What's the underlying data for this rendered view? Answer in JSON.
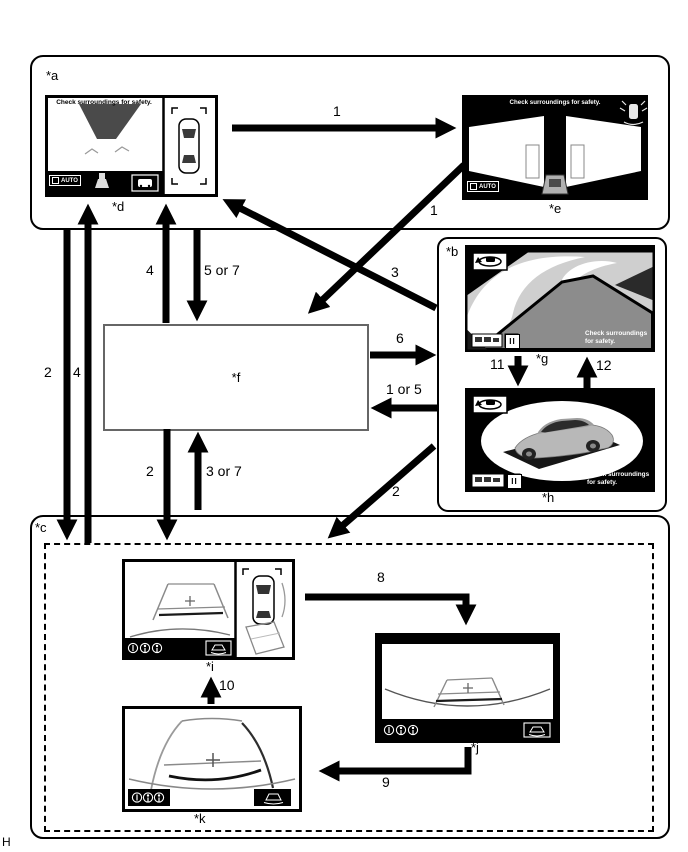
{
  "page": {
    "corner_mark": "H"
  },
  "panels": {
    "a": {
      "label": "*a"
    },
    "b": {
      "label": "*b"
    },
    "c": {
      "label": "*c"
    },
    "f": {
      "label": "*f"
    }
  },
  "screens": {
    "d": {
      "label": "*d",
      "caption": "Check surroundings for safety.",
      "auto": "AUTO"
    },
    "e": {
      "label": "*e",
      "caption": "Check surroundings for safety.",
      "auto": "AUTO"
    },
    "g": {
      "label": "*g",
      "caption": "Check surroundings for safety.",
      "pause": "II"
    },
    "h": {
      "label": "*h",
      "caption": "Check surroundings for safety.",
      "pause": "II"
    },
    "i": {
      "label": "*i"
    },
    "j": {
      "label": "*j"
    },
    "k": {
      "label": "*k"
    }
  },
  "arrows": {
    "a_to_e": "1",
    "e_to_f": "1",
    "b_to_a": "3",
    "a_to_c": "2",
    "c_to_a": "4",
    "f_to_a": "4",
    "a_to_f": "5 or 7",
    "f_to_c": "2",
    "c_to_f": "3 or 7",
    "f_to_b": "6",
    "b_to_f": "1 or 5",
    "g_to_h": "11",
    "h_to_g": "12",
    "b_to_c": "2",
    "i_to_j": "8",
    "j_to_k": "9",
    "k_to_i": "10"
  },
  "colors": {
    "ink": "#000000",
    "dark_gray": "#8c8c8c",
    "light_gray": "#cfcfcf"
  }
}
